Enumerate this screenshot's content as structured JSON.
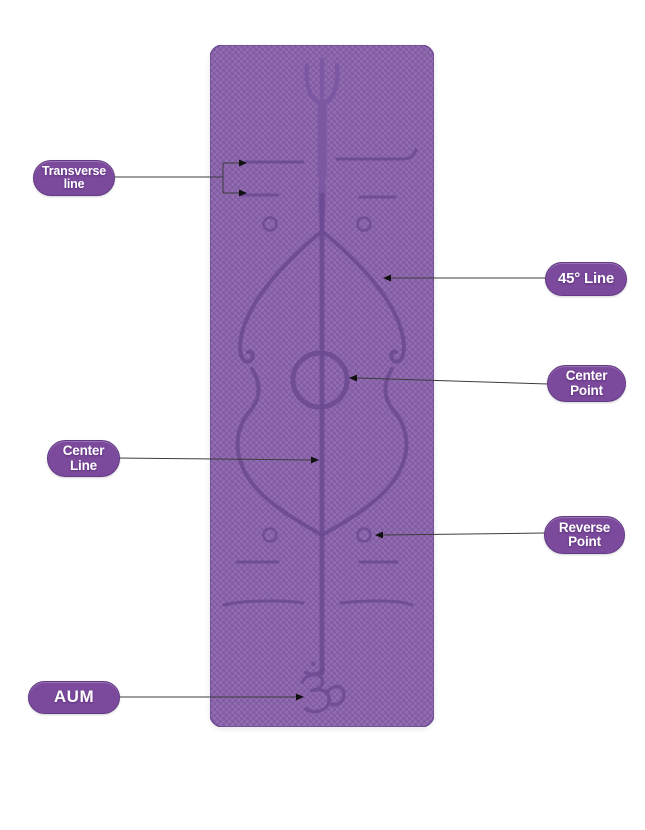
{
  "colors": {
    "background": "#ffffff",
    "mat_base": "#8a63a8",
    "mat_texture_light": "#9a74b8",
    "mat_texture_dark": "#7c56a0",
    "mat_marking": "#6b4a92",
    "label_bg": "#7c4a9c",
    "label_text": "#ffffff",
    "connector": "#3c3c3c"
  },
  "callouts": {
    "transverse_line": {
      "label": "Transverse\nline"
    },
    "forty_five_line": {
      "label": "45° Line"
    },
    "center_point": {
      "label": "Center\nPoint"
    },
    "center_line": {
      "label": "Center\nLine"
    },
    "reverse_point": {
      "label": "Reverse\nPoint"
    },
    "aum": {
      "label": "AUM"
    }
  },
  "mat": {
    "om_symbol": "ॐ",
    "trident_title": "trident"
  }
}
